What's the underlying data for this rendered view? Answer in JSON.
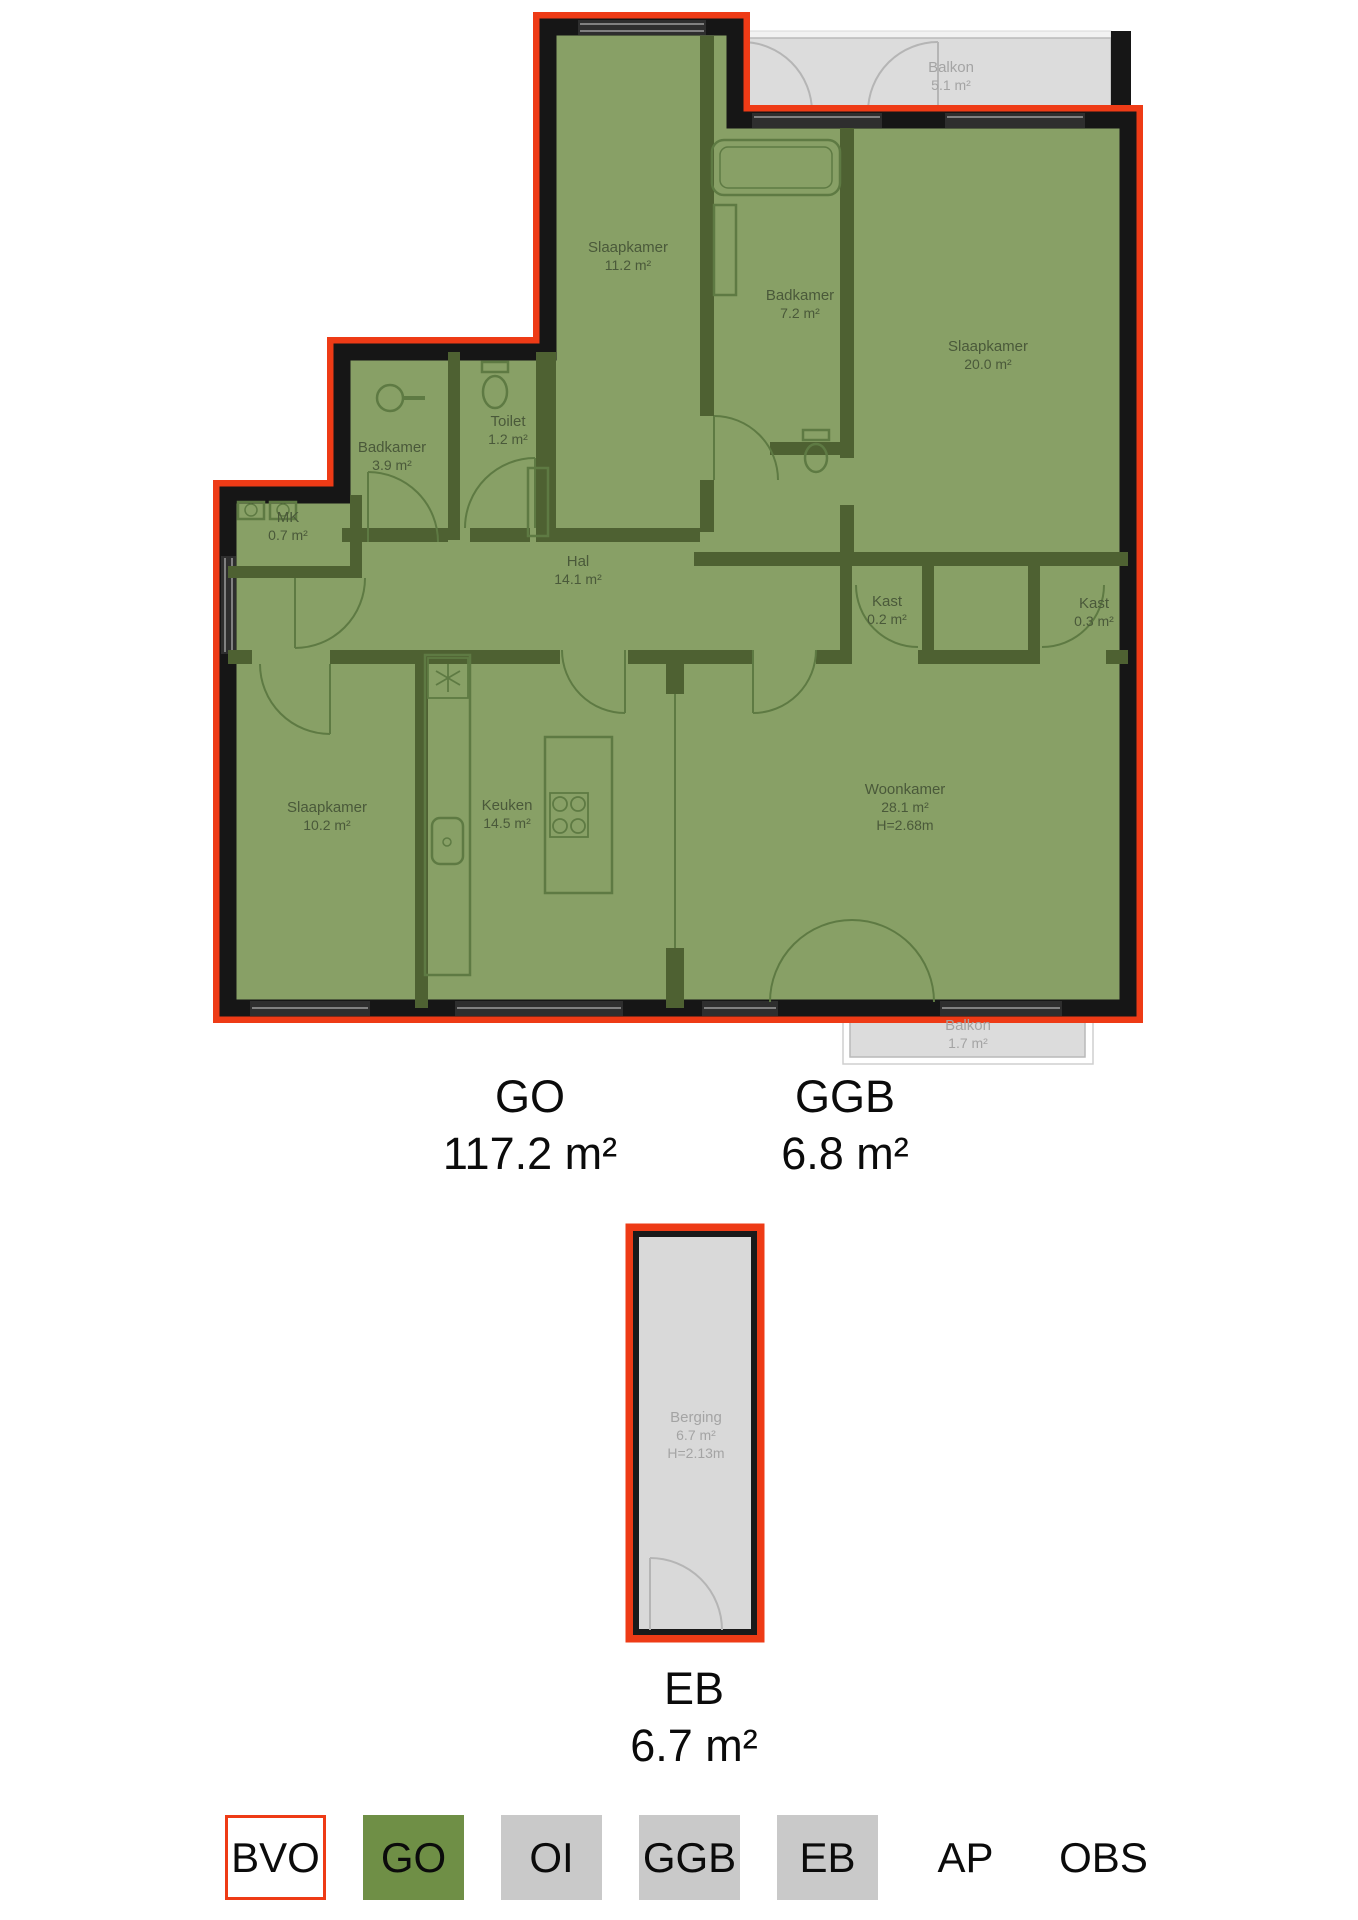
{
  "plan": {
    "rooms": [
      {
        "name": "Slaapkamer",
        "area": "11.2 m²"
      },
      {
        "name": "Badkamer",
        "area": "7.2 m²"
      },
      {
        "name": "Slaapkamer",
        "area": "20.0 m²"
      },
      {
        "name": "Toilet",
        "area": "1.2 m²"
      },
      {
        "name": "Badkamer",
        "area": "3.9 m²"
      },
      {
        "name": "MK",
        "area": "0.7 m²"
      },
      {
        "name": "Hal",
        "area": "14.1 m²"
      },
      {
        "name": "Kast",
        "area": "0.2 m²"
      },
      {
        "name": "Kast",
        "area": "0.3 m²"
      },
      {
        "name": "Slaapkamer",
        "area": "10.2 m²"
      },
      {
        "name": "Keuken",
        "area": "14.5 m²"
      },
      {
        "name": "Woonkamer",
        "area": "28.1 m²",
        "height": "H=2.68m"
      },
      {
        "name": "Balkon",
        "area": "5.1 m²"
      },
      {
        "name": "Balkon",
        "area": "1.7 m²"
      },
      {
        "name": "Berging",
        "area": "6.7 m²",
        "height": "H=2.13m"
      }
    ],
    "totals": [
      {
        "code": "GO",
        "area": "117.2 m²"
      },
      {
        "code": "GGB",
        "area": "6.8 m²"
      },
      {
        "code": "EB",
        "area": "6.7 m²"
      }
    ]
  },
  "legend": {
    "items": [
      {
        "label": "BVO"
      },
      {
        "label": "GO"
      },
      {
        "label": "OI"
      },
      {
        "label": "GGB"
      },
      {
        "label": "EB"
      },
      {
        "label": "AP"
      },
      {
        "label": "OBS"
      }
    ]
  },
  "colors": {
    "bvo_outline_red": "#ee3b16",
    "wall_black": "#161616",
    "go_fill_green": "#88a066",
    "legend_green": "#6f8f46",
    "interior_wall_green": "#4e6132",
    "balcony_gray": "#dcdcdc",
    "legend_gray": "#c9c9c9",
    "muted_text_gray": "#a4a4a4"
  }
}
